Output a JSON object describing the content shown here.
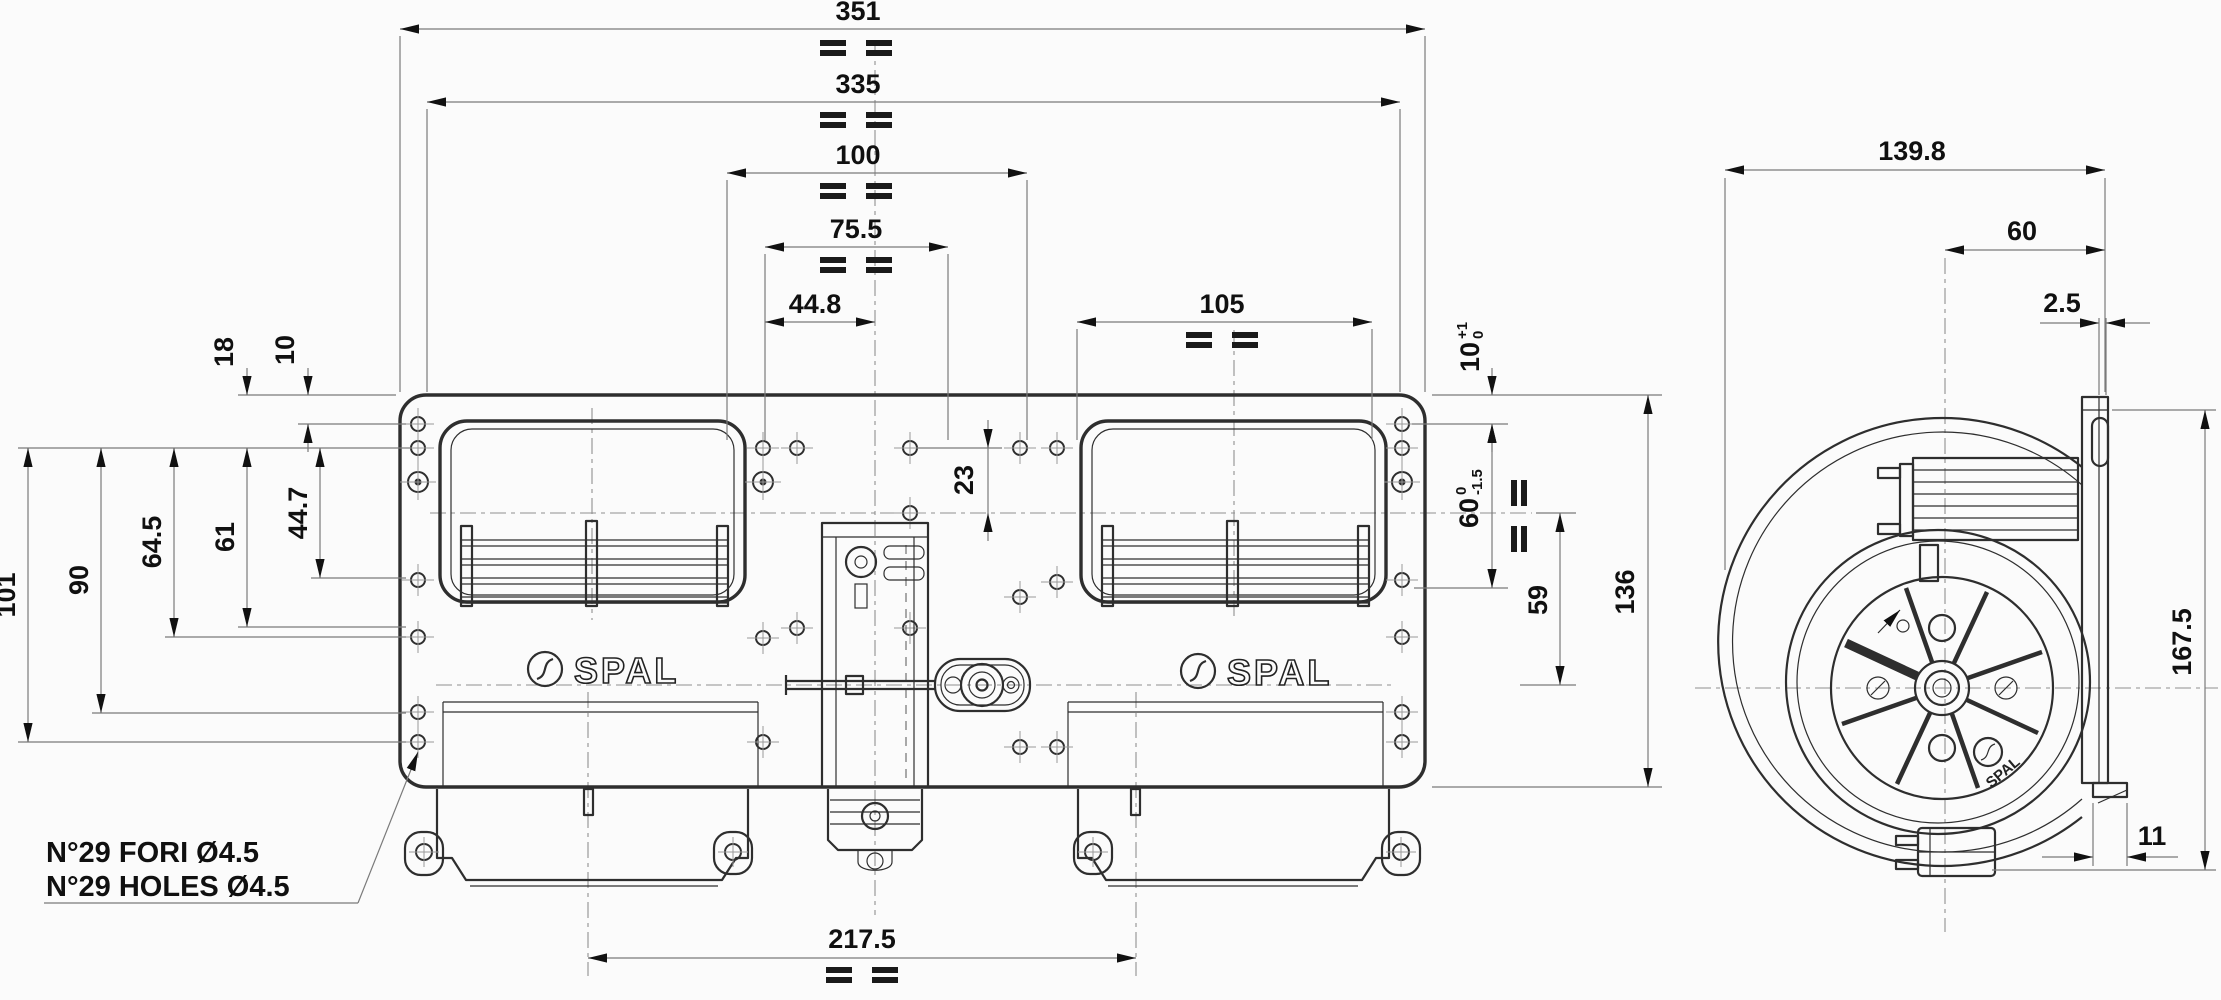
{
  "brand": {
    "name": "SPAL"
  },
  "note": {
    "line1": "N°29 FORI Ø4.5",
    "line2": "N°29 HOLES Ø4.5"
  },
  "dims": {
    "d351": "351",
    "d335": "335",
    "d100": "100",
    "d75_5": "75.5",
    "d44_8": "44.8",
    "d105": "105",
    "d18": "18",
    "d10": "10",
    "d101": "101",
    "d90": "90",
    "d64_5": "64.5",
    "d61": "61",
    "d44_7": "44.7",
    "d23": "23",
    "d10tol": {
      "main": "10",
      "sup": "+1",
      "sub": "0"
    },
    "d60tol": {
      "main": "60",
      "sup": "0",
      "sub": "-1.5"
    },
    "d59": "59",
    "d136": "136",
    "d217_5": "217.5",
    "d139_8": "139.8",
    "d60": "60",
    "d2_5": "2.5",
    "d167_5": "167.5",
    "d11": "11"
  }
}
